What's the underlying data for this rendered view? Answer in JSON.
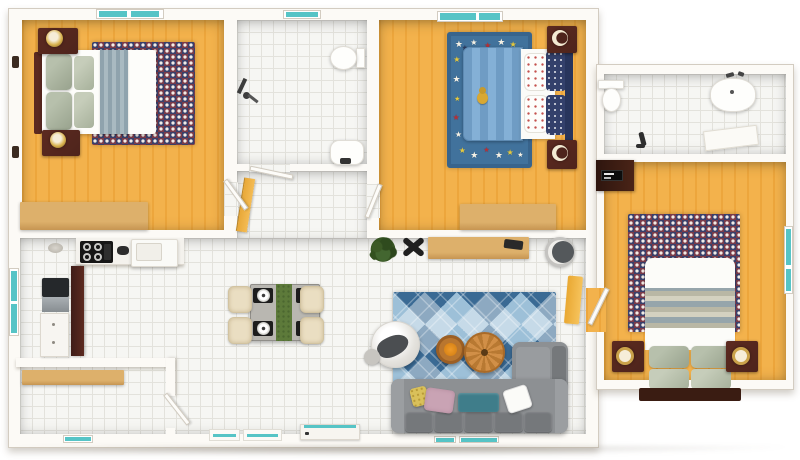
{
  "scene": {
    "title": "3D apartment floor plan - top-down render",
    "description": "Furnished two-bedroom apartment with side annex (bathroom + third bedroom), top view, no on-screen text",
    "style": "photoreal 3D dollhouse view"
  },
  "palette": {
    "wall": "#fcfaf6",
    "wall_edge": "#d3ccc1",
    "wood_light": "#f3b24c",
    "wood_dark": "#eda63c",
    "tile": "#f6f6f3",
    "tile_line": "#e3e2dc",
    "window_teal": "#56c4c6",
    "dark_wood": "#4e241c",
    "tan_light": "#ddb06b",
    "tan_dark": "#c69552",
    "sofa_gray": "#8d9093",
    "sofa_dark": "#75787b",
    "rug_blue": "#41729c",
    "argyle_dark": "#3a6a94",
    "argyle_light": "#9dc0d8",
    "maroon": "#7a3b49",
    "navy": "#39406b",
    "chair_cream": "#eadec2",
    "runner_green": "#5d7a3a",
    "orange_wood": "#b9762f",
    "burnt_orange": "#e8891d",
    "yellow_accent": "#f0b23f"
  },
  "rooms": [
    {
      "id": "bedroom-1",
      "label": "Bedroom 1 (top left)",
      "floor": "wood",
      "furniture": [
        "double bed with white duvet and slate runner",
        "sage pillows",
        "2 dark wood nightstands",
        "2 round lamps",
        "dotted check rug",
        "long tan dresser",
        "2 wall sconces",
        "double window top"
      ]
    },
    {
      "id": "bathroom-1",
      "label": "Bathroom (top middle)",
      "floor": "tile",
      "furniture": [
        "toilet",
        "round sink",
        "shower fixture",
        "door",
        "small window"
      ]
    },
    {
      "id": "hallway",
      "label": "Hallway",
      "floor": "tile",
      "furniture": [
        "amber open door",
        "bedroom door leaves"
      ]
    },
    {
      "id": "bedroom-2",
      "label": "Kids bedroom (top middle-right)",
      "floor": "wood",
      "furniture": [
        "bed with blue striped blanket",
        "teddy bear",
        "star rug",
        "2 nightstands with crescent lamps",
        "tan dresser",
        "two windows top"
      ]
    },
    {
      "id": "kitchen",
      "label": "Kitchen (left middle)",
      "floor": "tile",
      "furniture": [
        "L counter",
        "4-burner stove",
        "sink",
        "fridge",
        "maroon pantry cabinet",
        "base cabinet",
        "ceiling lamp",
        "side window"
      ]
    },
    {
      "id": "laundry",
      "label": "Laundry / storage (bottom left)",
      "floor": "tile",
      "furniture": [
        "wood shelf",
        "open door",
        "small bottom window"
      ]
    },
    {
      "id": "dining",
      "label": "Dining area (center)",
      "floor": "tile",
      "furniture": [
        "square table with green runner",
        "4 cream chairs",
        "4 black placemats with plates",
        "potted plant",
        "black X stool"
      ]
    },
    {
      "id": "living-room",
      "label": "Living room (bottom right)",
      "floor": "tile",
      "furniture": [
        "gray L sectional sofa",
        "5 back cushions",
        "yellow pink teal white pillows",
        "argyle blue rug",
        "2 round coffee tables",
        "white armchair with gray throw",
        "wood media console",
        "round bin",
        "yellow accent",
        "flat entry door with teal edge",
        "2 teal doormats",
        "2 bottom windows"
      ]
    },
    {
      "id": "bathroom-2",
      "label": "Annex bathroom (top right)",
      "floor": "tile",
      "furniture": [
        "toilet",
        "large round sink",
        "faucet set",
        "bench",
        "floor fixture"
      ]
    },
    {
      "id": "bedroom-3",
      "label": "Annex bedroom (bottom right)",
      "floor": "wood",
      "furniture": [
        "bed with striped duvet and 4 sage pillows",
        "dotted check rug",
        "2 nightstands with ring lamps",
        "TV stand with TV",
        "right wall window",
        "door"
      ]
    }
  ],
  "bedroom2_rug": {
    "stars": [
      {
        "x": 5,
        "y": 4,
        "c": "#f6f2e6",
        "s": 9
      },
      {
        "x": 25,
        "y": 2,
        "c": "#f6f2e6",
        "s": 8
      },
      {
        "x": 43,
        "y": 5,
        "c": "#b92f35",
        "s": 8
      },
      {
        "x": 60,
        "y": 2,
        "c": "#f6f2e6",
        "s": 9
      },
      {
        "x": 76,
        "y": 4,
        "c": "#e5c93e",
        "s": 8
      },
      {
        "x": 88,
        "y": 9,
        "c": "#f6f2e6",
        "s": 7
      },
      {
        "x": 14,
        "y": 7,
        "c": "#2c3a5e",
        "s": 7
      },
      {
        "x": 3,
        "y": 16,
        "c": "#e5c93e",
        "s": 8
      },
      {
        "x": 2,
        "y": 31,
        "c": "#f6f2e6",
        "s": 9
      },
      {
        "x": 4,
        "y": 47,
        "c": "#e5c93e",
        "s": 7
      },
      {
        "x": 2,
        "y": 61,
        "c": "#b92f35",
        "s": 8
      },
      {
        "x": 5,
        "y": 74,
        "c": "#f6f2e6",
        "s": 8
      },
      {
        "x": 10,
        "y": 87,
        "c": "#e5c93e",
        "s": 8
      },
      {
        "x": 25,
        "y": 91,
        "c": "#f6f2e6",
        "s": 9
      },
      {
        "x": 42,
        "y": 87,
        "c": "#b92f35",
        "s": 7
      },
      {
        "x": 57,
        "y": 91,
        "c": "#f6f2e6",
        "s": 9
      },
      {
        "x": 72,
        "y": 88,
        "c": "#e5c93e",
        "s": 8
      },
      {
        "x": 86,
        "y": 91,
        "c": "#f6f2e6",
        "s": 7
      }
    ]
  }
}
